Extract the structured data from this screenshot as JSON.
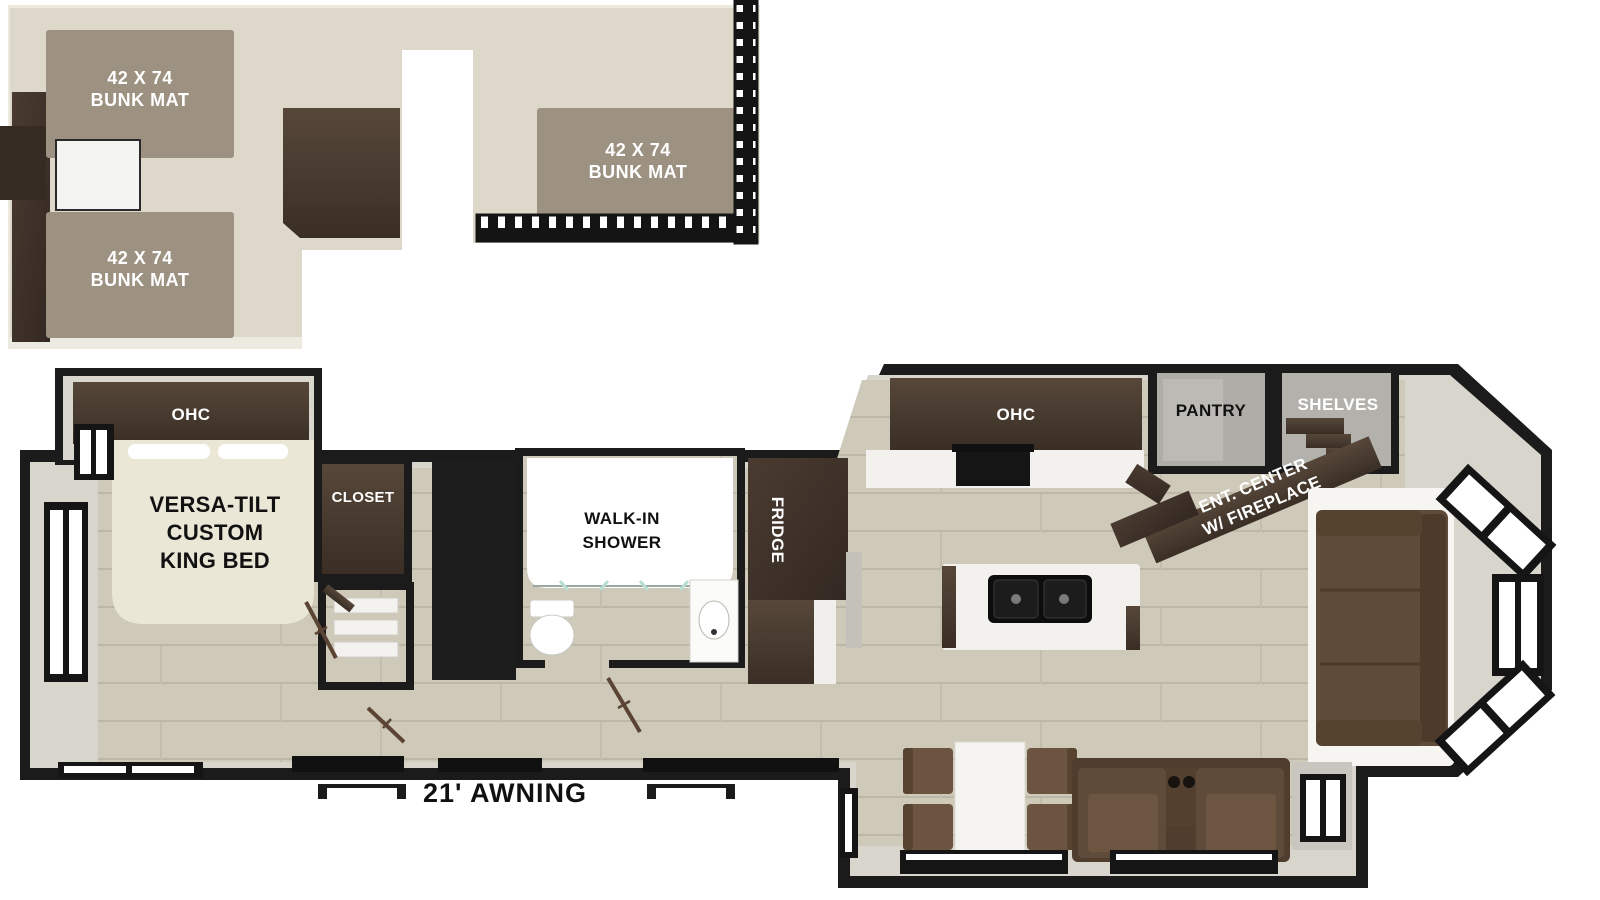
{
  "palette": {
    "wall": "#1b1b1b",
    "lining": "#d8d5cd",
    "floor_wood": "#cec9b9",
    "loft_floor": "#ddd8ca",
    "bunk_mat": "#9d9182",
    "dark_wood": "#4a3c31",
    "bed_cream": "#ebe7d7",
    "sofa_brown": "#5f4b3a",
    "white": "#ffffff"
  },
  "loft": {
    "bunk_mats": [
      {
        "size": "42 X 74",
        "name": "BUNK MAT"
      },
      {
        "size": "42 X 74",
        "name": "BUNK MAT"
      },
      {
        "size": "42 X 74",
        "name": "BUNK MAT"
      }
    ]
  },
  "main": {
    "bedroom": {
      "ohc": "OHC",
      "bed_lines": [
        "VERSA-TILT",
        "CUSTOM",
        "KING BED"
      ],
      "closet": "CLOSET"
    },
    "bathroom": {
      "shower_lines": [
        "WALK-IN",
        "SHOWER"
      ]
    },
    "kitchen": {
      "ohc": "OHC",
      "fridge": "FRIDGE",
      "pantry": "PANTRY",
      "shelves": "SHELVES"
    },
    "living": {
      "ent_center_lines": [
        "ENT. CENTER",
        "W/ FIREPLACE"
      ]
    },
    "exterior": {
      "awning": "21' AWNING"
    }
  }
}
